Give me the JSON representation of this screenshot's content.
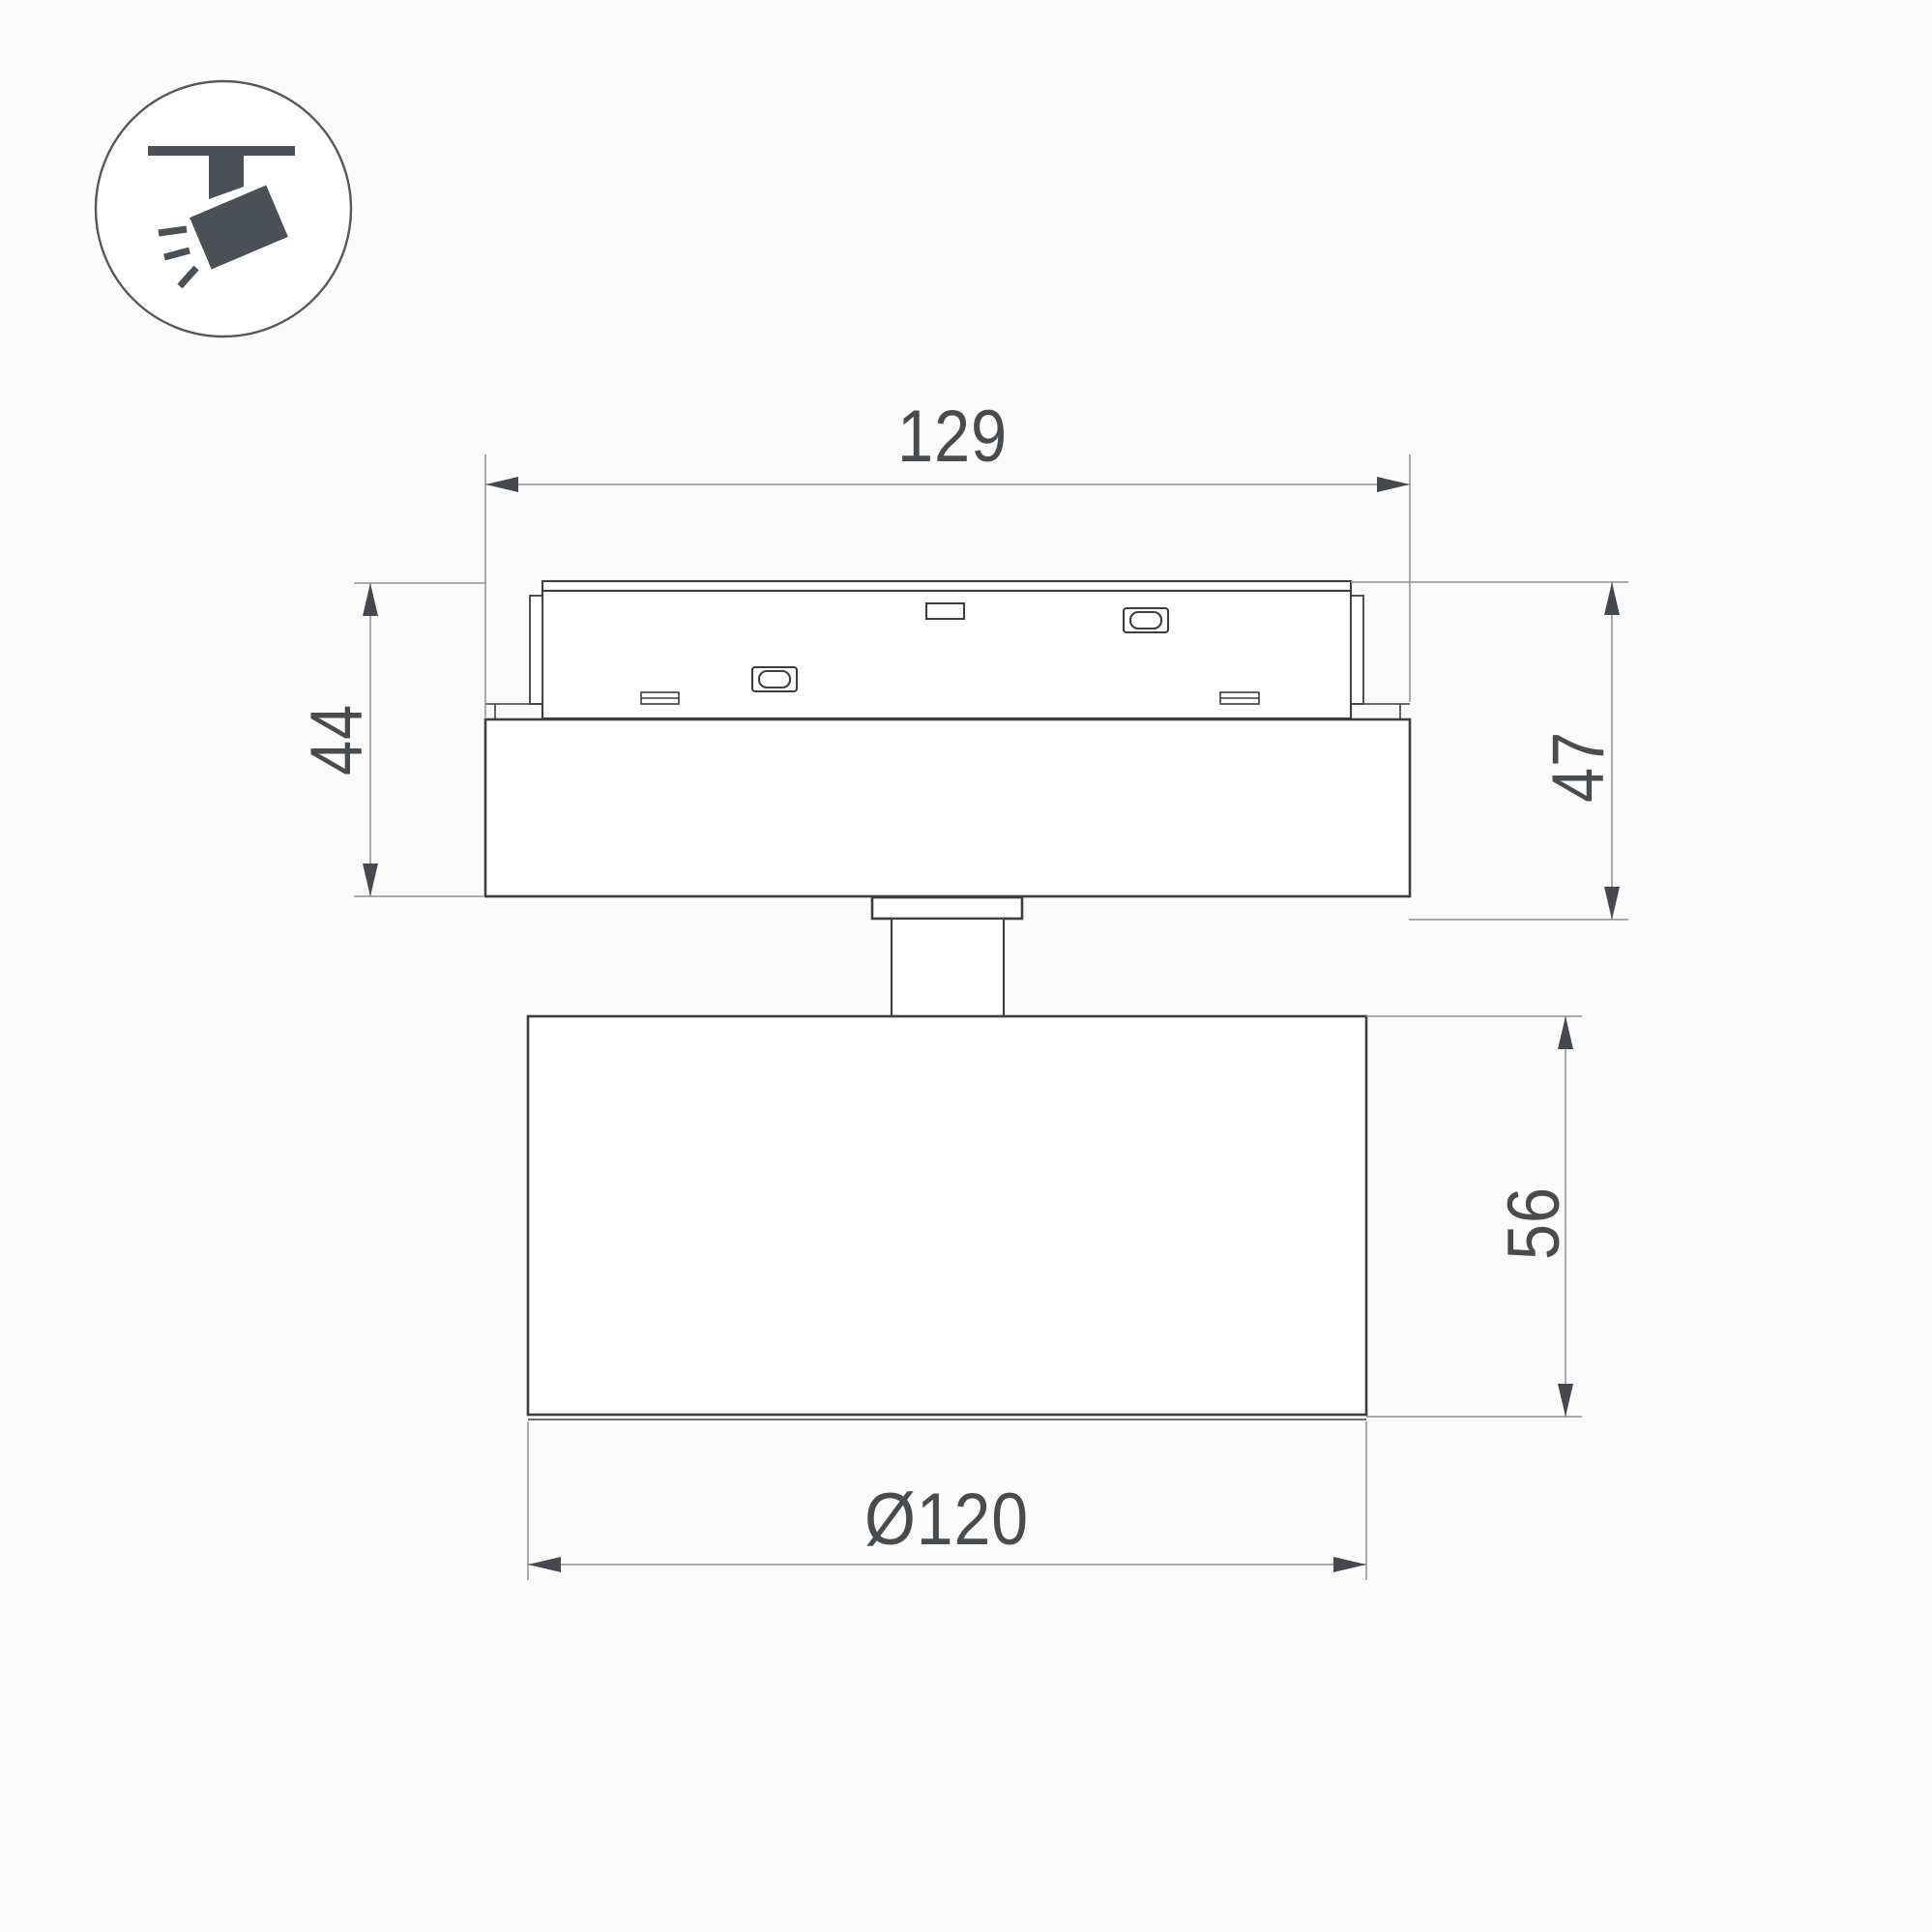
{
  "page": {
    "type": "product-dimension-drawing",
    "background": "#fbfbfb"
  },
  "icon": {
    "name": "ceiling-track-spotlight-icon",
    "description": "spotlight hanging from ceiling track, tilted, emitting light rays"
  },
  "dimensions": {
    "track_length": {
      "label": "129",
      "value": 129
    },
    "adapter_height": {
      "label": "44",
      "value": 44
    },
    "overall_height": {
      "label": "47",
      "value": 47
    },
    "body_height": {
      "label": "56",
      "value": 56
    },
    "body_diameter": {
      "label": "Ø120",
      "value": 120
    }
  },
  "colors": {
    "bg": "#fbfbfb",
    "line": "#3b3f43",
    "thin": "#8e9194",
    "arrow": "#45484c",
    "text": "#494c4f",
    "icon": "#4a5056"
  }
}
